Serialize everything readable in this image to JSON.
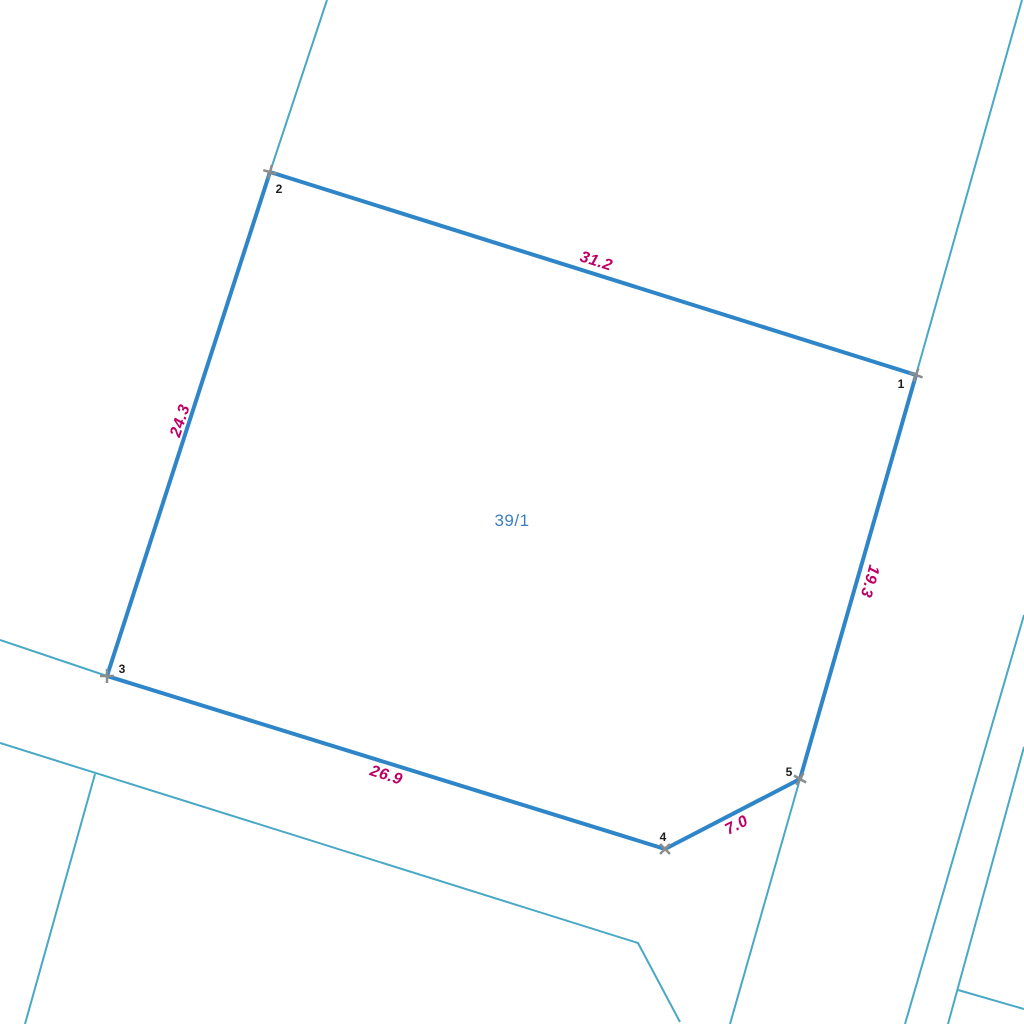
{
  "map": {
    "width": 1024,
    "height": 1024,
    "background": "#ffffff"
  },
  "colors": {
    "parcel_stroke": "#2e86c8",
    "background_line": "#49a8c5",
    "measurement_text": "#bc0065",
    "parcel_label_text": "#3b7fc4",
    "vertex_marker": "#8c8c8c",
    "vertex_number_text": "#1c1c1c"
  },
  "parcel": {
    "label": "39/1",
    "label_pos": {
      "x": 512,
      "y": 521
    },
    "vertices": [
      {
        "number": "1",
        "x": 916,
        "y": 375,
        "marker_angle": 20,
        "num_x": 901,
        "num_y": 384
      },
      {
        "number": "2",
        "x": 270,
        "y": 172,
        "marker_angle": 15,
        "num_x": 279,
        "num_y": 189
      },
      {
        "number": "3",
        "x": 107,
        "y": 676,
        "marker_angle": 0,
        "num_x": 122,
        "num_y": 669
      },
      {
        "number": "4",
        "x": 665,
        "y": 849,
        "marker_angle": 45,
        "num_x": 663,
        "num_y": 837
      },
      {
        "number": "5",
        "x": 800,
        "y": 779,
        "marker_angle": 30,
        "num_x": 789,
        "num_y": 772
      }
    ],
    "edges": [
      {
        "from": "2",
        "to": "1",
        "length_label": "31.2",
        "label_x": 596,
        "label_y": 262,
        "label_rotation": 17.5
      },
      {
        "from": "3",
        "to": "2",
        "length_label": "24.3",
        "label_x": 181,
        "label_y": 421,
        "label_rotation": -72
      },
      {
        "from": "1",
        "to": "5",
        "length_label": "19.3",
        "label_x": 869,
        "label_y": 581,
        "label_rotation": 106
      },
      {
        "from": "3",
        "to": "4",
        "length_label": "26.9",
        "label_x": 386,
        "label_y": 776,
        "label_rotation": 17.5
      },
      {
        "from": "4",
        "to": "5",
        "length_label": "7.0",
        "label_x": 737,
        "label_y": 826,
        "label_rotation": -27.5
      }
    ]
  },
  "background_lines": [
    {
      "id": "ext-above-vertex-2",
      "points": [
        [
          327,
          0
        ],
        [
          270,
          172
        ]
      ]
    },
    {
      "id": "ext-above-vertex-1",
      "points": [
        [
          1022,
          0
        ],
        [
          916,
          375
        ]
      ]
    },
    {
      "id": "ext-below-vertex-5",
      "points": [
        [
          800,
          779
        ],
        [
          730,
          1024
        ]
      ]
    },
    {
      "id": "road-upper-line",
      "points": [
        [
          0,
          640
        ],
        [
          107,
          676
        ]
      ]
    },
    {
      "id": "road-lower-line",
      "points": [
        [
          0,
          743
        ],
        [
          638,
          943
        ],
        [
          680,
          1022
        ]
      ]
    },
    {
      "id": "branch-lower-left",
      "points": [
        [
          95,
          774
        ],
        [
          25,
          1024
        ]
      ]
    },
    {
      "id": "right-boundary-1",
      "points": [
        [
          1024,
          615
        ],
        [
          905,
          1024
        ]
      ]
    },
    {
      "id": "right-boundary-2",
      "points": [
        [
          1024,
          747
        ],
        [
          948,
          1024
        ]
      ]
    },
    {
      "id": "right-branch",
      "points": [
        [
          958,
          990
        ],
        [
          1024,
          1009
        ]
      ]
    }
  ]
}
